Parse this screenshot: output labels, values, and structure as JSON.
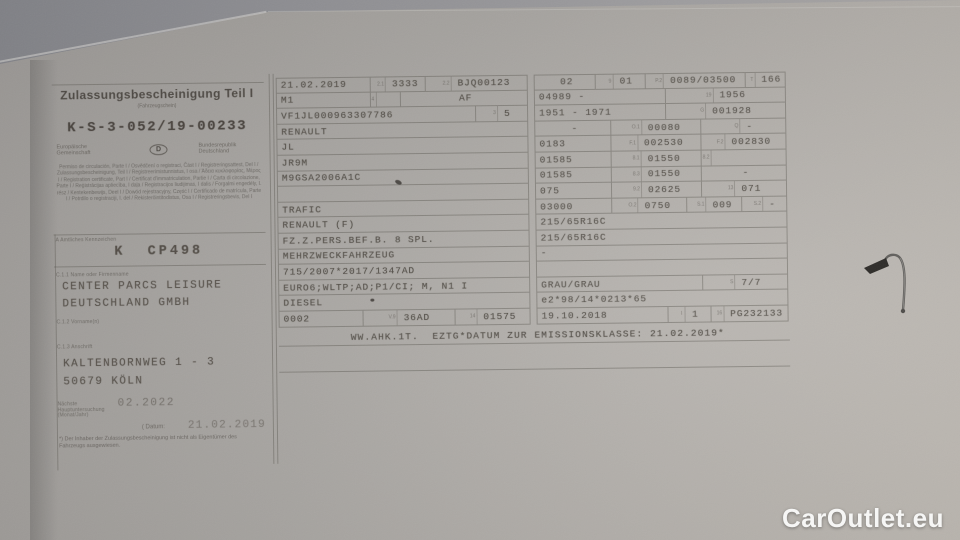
{
  "colors": {
    "surface": "#8f8f93",
    "paper": "#aca9a5",
    "ink": "#4b463f",
    "table_line": "#55504a",
    "watermark_text": "#f6f6f5"
  },
  "doc": {
    "title": "Zulassungsbescheinigung Teil I",
    "subtitle": "(Fahrzeugschein)",
    "number": "K-S-3-052/19-00233",
    "eu_community": "Europäische Gemeinschaft",
    "country_letter": "D",
    "country_name": "Bundesrepublik Deutschland",
    "multilingual": "Permiso de circulación, Parte I / Osvědčení o registraci, Část I / Registreringsattest, Del I / Zulassungsbescheinigung, Teil I / Registreerimistunnistus, I osa / Άδεια κυκλοφορίας, Μέρος I / Registration certificate, Part I / Certificat d'immatriculation, Partie I / Carta di circolazione, Parte I / Reģistrācijas apliecība, I daļa / Registracijos liudijimas, I dalis / Forgalmi engedély, I. rész / Kentekenbewijs, Deel I / Dowód rejestracyjny, Część I / Certificado de matrícula, Parte I / Potrdilo o registraciji, I. del / Rekisteröintitodistus, Osa I / Registreringsbevis, Del I",
    "plate_label": "A  Amtliches Kennzeichen",
    "plate": "K  CP498",
    "owner_label": "C.1.1  Name oder Firmenname",
    "owner1": "CENTER PARCS LEISURE",
    "owner2": "DEUTSCHLAND GMBH",
    "firstname_label": "C.1.2  Vorname(n)",
    "address_label": "C.1.3  Anschrift",
    "address1": "KALTENBORNWEG 1 - 3",
    "address2": "50679 KÖLN",
    "hu_label": "Nächste Hauptuntersuchung (Monat/Jahr)",
    "hu_value": "02.2022",
    "date_label": "( Datum:",
    "date_value": "21.02.2019",
    "footnote": "*) Der Inhaber der Zulassungsbescheinigung ist nicht als Eigentümer des Fahrzeugs ausgewiesen."
  },
  "middle": {
    "rows": [
      [
        {
          "v": "21.02.2019",
          "w": 37
        },
        {
          "c": "2.1",
          "v": "3333",
          "w": 22,
          "a": "c"
        },
        {
          "c": "2.2",
          "v": "BJQ00123",
          "w": 41,
          "a": "c"
        }
      ],
      [
        {
          "v": "M1",
          "w": 37
        },
        {
          "c": "4",
          "v": "",
          "w": 12
        },
        {
          "v": "AF",
          "w": 51,
          "a": "c"
        }
      ],
      [
        {
          "v": "VF1JL000963307786",
          "w": 79
        },
        {
          "c": "3",
          "v": "5",
          "w": 21,
          "a": "c"
        }
      ],
      [
        {
          "v": "RENAULT",
          "w": 100
        }
      ],
      [
        {
          "v": "JL",
          "w": 100
        }
      ],
      [
        {
          "v": "JR9M",
          "w": 100
        }
      ],
      [
        {
          "v": "M9GSA2006A1C",
          "w": 100
        }
      ],
      [
        {
          "v": "",
          "w": 100
        }
      ],
      [
        {
          "v": "TRAFIC",
          "w": 100
        }
      ],
      [
        {
          "v": "RENAULT (F)",
          "w": 100
        }
      ],
      [
        {
          "v": "FZ.Z.PERS.BEF.B. 8 SPL.",
          "w": 100
        }
      ],
      [
        {
          "v": "MEHRZWECKFAHRZEUG",
          "w": 100
        }
      ],
      [
        {
          "v": "715/2007*2017/1347AD",
          "w": 100
        }
      ],
      [
        {
          "v": "EURO6;WLTP;AD;P1/CI; M, N1 I",
          "w": 100
        }
      ],
      [
        {
          "v": "DIESEL",
          "w": 100
        }
      ],
      [
        {
          "v": "0002",
          "w": 33
        },
        {
          "c": "V.9",
          "v": "36AD",
          "w": 37,
          "a": "c"
        },
        {
          "c": "14",
          "v": "01575",
          "w": 30,
          "a": "c"
        }
      ]
    ]
  },
  "right": {
    "rows": [
      [
        {
          "v": "02",
          "w": 24,
          "a": "c"
        },
        {
          "c": "9",
          "v": "01",
          "w": 20,
          "a": "c"
        },
        {
          "c": "P.2",
          "v": "0089/03500",
          "w": 40,
          "a": "c"
        },
        {
          "c": "T",
          "v": "166",
          "w": 16,
          "a": "c"
        }
      ],
      [
        {
          "v": "04989 -",
          "w": 52
        },
        {
          "c": "19",
          "v": "1956",
          "w": 48,
          "a": "c"
        }
      ],
      [
        {
          "v": "1951 - 1971",
          "w": 52
        },
        {
          "c": "G",
          "v": "001928",
          "w": 48,
          "a": "c"
        }
      ],
      [
        {
          "v": "-",
          "w": 30,
          "a": "c"
        },
        {
          "c": "O.1",
          "v": "00080",
          "w": 36,
          "a": "c"
        },
        {
          "c": "Q",
          "v": "-",
          "w": 34,
          "a": "c"
        }
      ],
      [
        {
          "v": "0183",
          "w": 30
        },
        {
          "c": "F.1",
          "v": "002530",
          "w": 36,
          "a": "c"
        },
        {
          "c": "F.2",
          "v": "002830",
          "w": 34,
          "a": "c"
        }
      ],
      [
        {
          "v": "01585",
          "w": 30
        },
        {
          "c": "8.1",
          "v": "01550",
          "w": 36,
          "a": "c"
        },
        {
          "c": "8.2",
          "v": "",
          "w": 34
        }
      ],
      [
        {
          "v": "01585",
          "w": 30
        },
        {
          "c": "8.3",
          "v": "01550",
          "w": 36,
          "a": "c"
        },
        {
          "v": "-",
          "w": 34,
          "a": "c"
        }
      ],
      [
        {
          "v": "075",
          "w": 30
        },
        {
          "c": "9.2",
          "v": "02625",
          "w": 36,
          "a": "c"
        },
        {
          "c": "13",
          "v": "071",
          "w": 34,
          "a": "c"
        }
      ],
      [
        {
          "v": "03000",
          "w": 30
        },
        {
          "c": "O.2",
          "v": "0750",
          "w": 30,
          "a": "c"
        },
        {
          "c": "S.1",
          "v": "009",
          "w": 22,
          "a": "c"
        },
        {
          "c": "S.2",
          "v": "-",
          "w": 18,
          "a": "c"
        }
      ],
      [
        {
          "v": "215/65R16C",
          "w": 100
        }
      ],
      [
        {
          "v": "215/65R16C",
          "w": 100
        }
      ],
      [
        {
          "v": "-",
          "w": 100
        }
      ],
      [
        {
          "v": "",
          "w": 100
        }
      ],
      [
        {
          "v": "GRAU/GRAU",
          "w": 66
        },
        {
          "c": "S",
          "v": "7/7",
          "w": 34,
          "a": "c"
        }
      ],
      [
        {
          "v": "e2*98/14*0213*65",
          "w": 100
        }
      ],
      [
        {
          "v": "19.10.2018",
          "w": 52
        },
        {
          "c": "I",
          "v": "1",
          "w": 17,
          "a": "c"
        },
        {
          "c": "16",
          "v": "PG232133",
          "w": 31,
          "a": "c"
        }
      ]
    ]
  },
  "bottom_line": "WW.AHK.1T.  EZTG*DATUM ZUR EMISSIONSKLASSE: 21.02.2019*",
  "watermark": "CarOutlet.eu"
}
